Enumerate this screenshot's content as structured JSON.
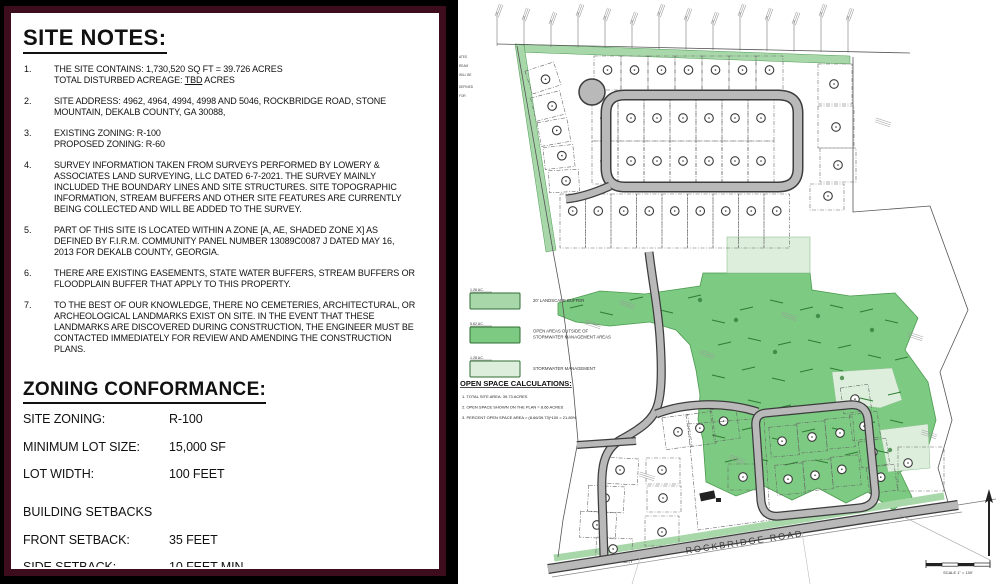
{
  "panel": {
    "title": "SITE NOTES:",
    "notes": [
      {
        "num": "1.",
        "lines": [
          "THE SITE CONTAINS: 1,730,520 SQ FT = 39.726 ACRES",
          {
            "pre": "TOTAL DISTURBED ACREAGE: ",
            "u": "TBD",
            "post": " ACRES"
          }
        ]
      },
      {
        "num": "2.",
        "lines": [
          "SITE ADDRESS: 4962, 4964, 4994, 4998 AND 5046, ROCKBRIDGE ROAD, STONE MOUNTAIN, DEKALB COUNTY, GA 30088,"
        ]
      },
      {
        "num": "3.",
        "lines": [
          "EXISTING ZONING: R-100",
          "PROPOSED ZONING: R-60"
        ]
      },
      {
        "num": "4.",
        "lines": [
          "SURVEY INFORMATION TAKEN FROM SURVEYS PERFORMED BY LOWERY & ASSOCIATES LAND SURVEYING, LLC DATED 6-7-2021. THE SURVEY MAINLY INCLUDED THE BOUNDARY LINES AND SITE STRUCTURES. SITE TOPOGRAPHIC INFORMATION, STREAM BUFFERS AND OTHER SITE FEATURES ARE CURRENTLY BEING COLLECTED AND WILL BE ADDED TO THE SURVEY."
        ]
      },
      {
        "num": "5.",
        "lines": [
          "PART OF THIS SITE IS LOCATED WITHIN A ZONE [A, AE, SHADED ZONE X] AS DEFINED BY F.I.R.M. COMMUNITY PANEL NUMBER 13089C0087 J DATED MAY 16, 2013 FOR DEKALB COUNTY, GEORGIA."
        ]
      },
      {
        "num": "6.",
        "lines": [
          "THERE ARE EXISTING EASEMENTS, STATE WATER BUFFERS, STREAM BUFFERS OR FLOODPLAIN BUFFER THAT APPLY TO THIS PROPERTY."
        ]
      },
      {
        "num": "7.",
        "lines": [
          "TO THE BEST OF OUR KNOWLEDGE, THERE NO CEMETERIES, ARCHITECTURAL, OR ARCHEOLOGICAL LANDMARKS EXIST ON SITE. IN THE EVENT THAT THESE LANDMARKS ARE DISCOVERED DURING CONSTRUCTION, THE ENGINEER MUST BE CONTACTED IMMEDIATELY FOR REVIEW AND AMENDING THE CONSTRUCTION PLANS."
        ]
      }
    ],
    "zoning": {
      "title": "ZONING CONFORMANCE:",
      "rows": [
        {
          "label": "SITE ZONING:",
          "value": "R-100"
        },
        {
          "label": "MINIMUM LOT SIZE:",
          "value": "15,000 SF"
        },
        {
          "label": "LOT WIDTH:",
          "value": "100 FEET"
        }
      ]
    },
    "setbacks": {
      "title": "BUILDING SETBACKS",
      "rows": [
        {
          "label": "FRONT SETBACK:",
          "value": "35 FEET"
        },
        {
          "label": "SIDE SETBACK:",
          "value": "10 FEET MIN."
        },
        {
          "label": "REAR SETBACK:",
          "value": "40 FEET"
        }
      ]
    }
  },
  "map": {
    "legend": {
      "items": [
        {
          "area": "1.26 AC.",
          "label": "20' LANDSCAPE BUFFER",
          "color": "#a8d8aa"
        },
        {
          "area": "5.62 AC.",
          "label": "OPEN AREAS OUTSIDE OF\nSTORMWATER MANAGEMENT AREAS",
          "color": "#7dcb82"
        },
        {
          "area": "1.28 AC.",
          "label": "STORMWATER MANAGEMENT",
          "color": "#ddefdc"
        }
      ]
    },
    "open_space": {
      "title": "OPEN SPACE CALCULATIONS:",
      "lines": [
        "1.   TOTAL SITE AREA: 39.73 ACRES",
        "2.   OPEN SPACE SHOWN ON THE PLAN = 8.66 ACRES",
        "3.   PERCENT OPEN SPACE AREA = (8.66/39.73)*100 = 21.80%"
      ]
    },
    "road_label": "ROCKBRIDGE ROAD",
    "scale_label": "SCALE 1\" = 100'",
    "edge_fragments": [
      "ATES",
      "REAM",
      "WILL BE",
      "DEFINED",
      "FOR"
    ]
  },
  "colors": {
    "buffer_green": "#a8d8aa",
    "open_green": "#7dcb82",
    "storm_green": "#ddefdc",
    "road_gray": "#b9b9b9",
    "road_casing": "#3c3c3c",
    "panel_border": "#3d0d1d"
  }
}
